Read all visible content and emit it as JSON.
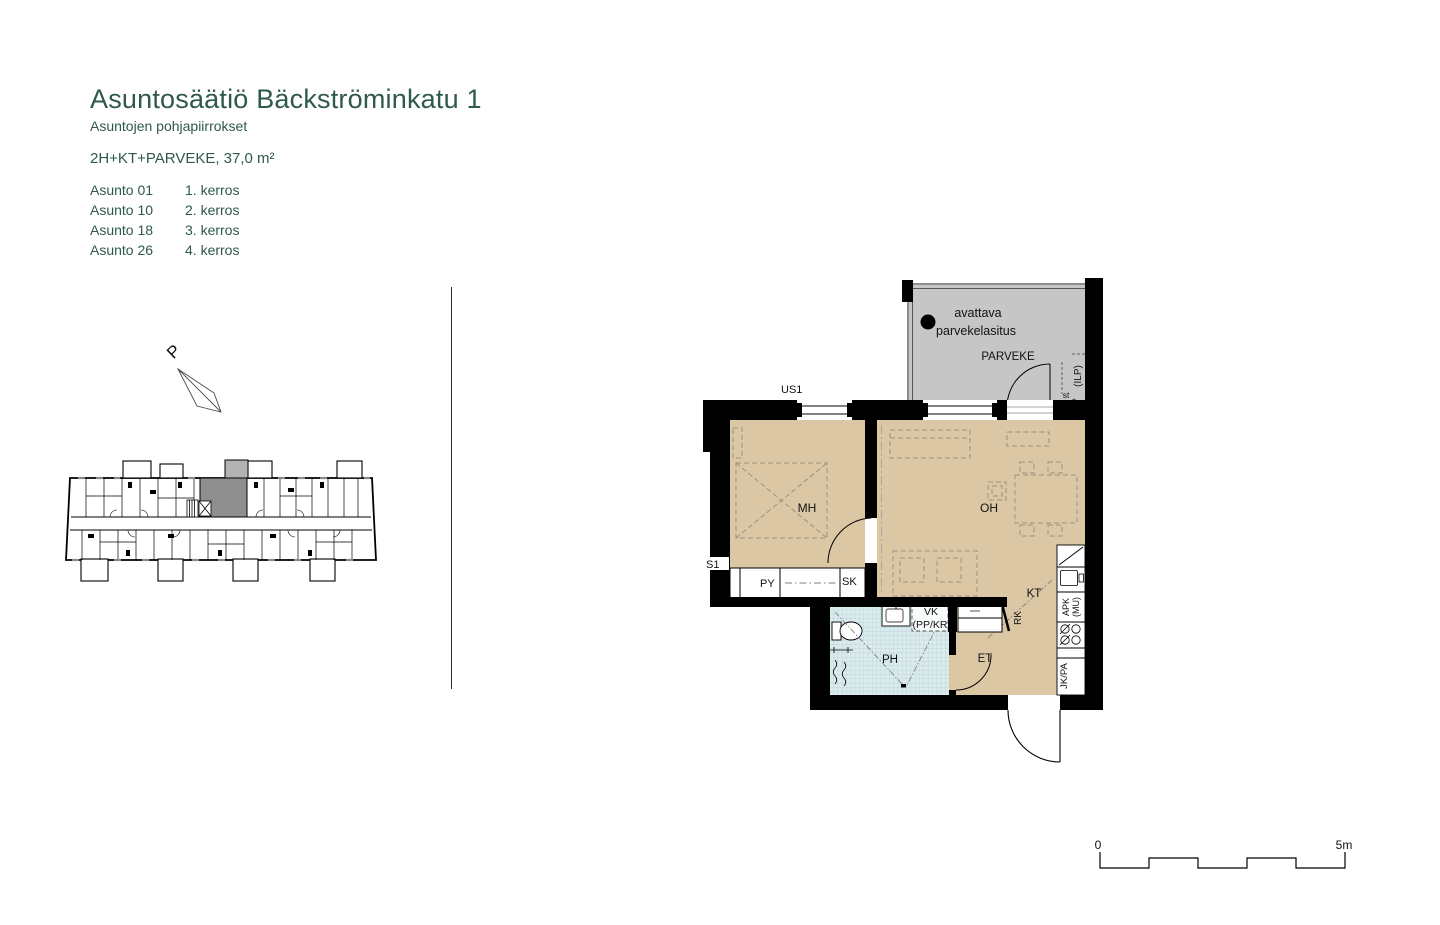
{
  "header": {
    "title": "Asuntosäätiö Bäckströminkatu 1",
    "subtitle": "Asuntojen pohjapiirrokset",
    "apartment_type": "2H+KT+PARVEKE, 37,0 m²",
    "apartments": [
      {
        "unit": "Asunto 01",
        "floor": "1. kerros"
      },
      {
        "unit": "Asunto 10",
        "floor": "2. kerros"
      },
      {
        "unit": "Asunto 18",
        "floor": "3. kerros"
      },
      {
        "unit": "Asunto 26",
        "floor": "4. kerros"
      }
    ]
  },
  "north_arrow": {
    "label": "P"
  },
  "floor_plan": {
    "rooms": {
      "bedroom": "MH",
      "living_room": "OH",
      "kitchen": "KT",
      "entrance": "ET",
      "bathroom": "PH",
      "balcony": "PARVEKE"
    },
    "labels": {
      "balcony_glazing_line1": "avattava",
      "balcony_glazing_line2": "parvekelasitus",
      "exterior_wall_type": "US1",
      "wall_type": "S1",
      "closet_py": "PY",
      "closet_sk": "SK",
      "washer_reservation": "VK",
      "washer_reservation_detail": "(PP/KR",
      "entry_closet": "RK",
      "dishwasher": "APK",
      "dishwasher_detail": "(MU)",
      "fridge_freezer": "JK/PA",
      "heat_pump": "(ILP)",
      "socket": "st"
    }
  },
  "scale_bar": {
    "start": "0",
    "end": "5m"
  },
  "colors": {
    "heading_green": "#2e594b",
    "floor_beige": "#dcc7a4",
    "balcony_grey": "#c6c6c6",
    "tile_blue": "#dcebee",
    "wall_black": "#000000"
  }
}
